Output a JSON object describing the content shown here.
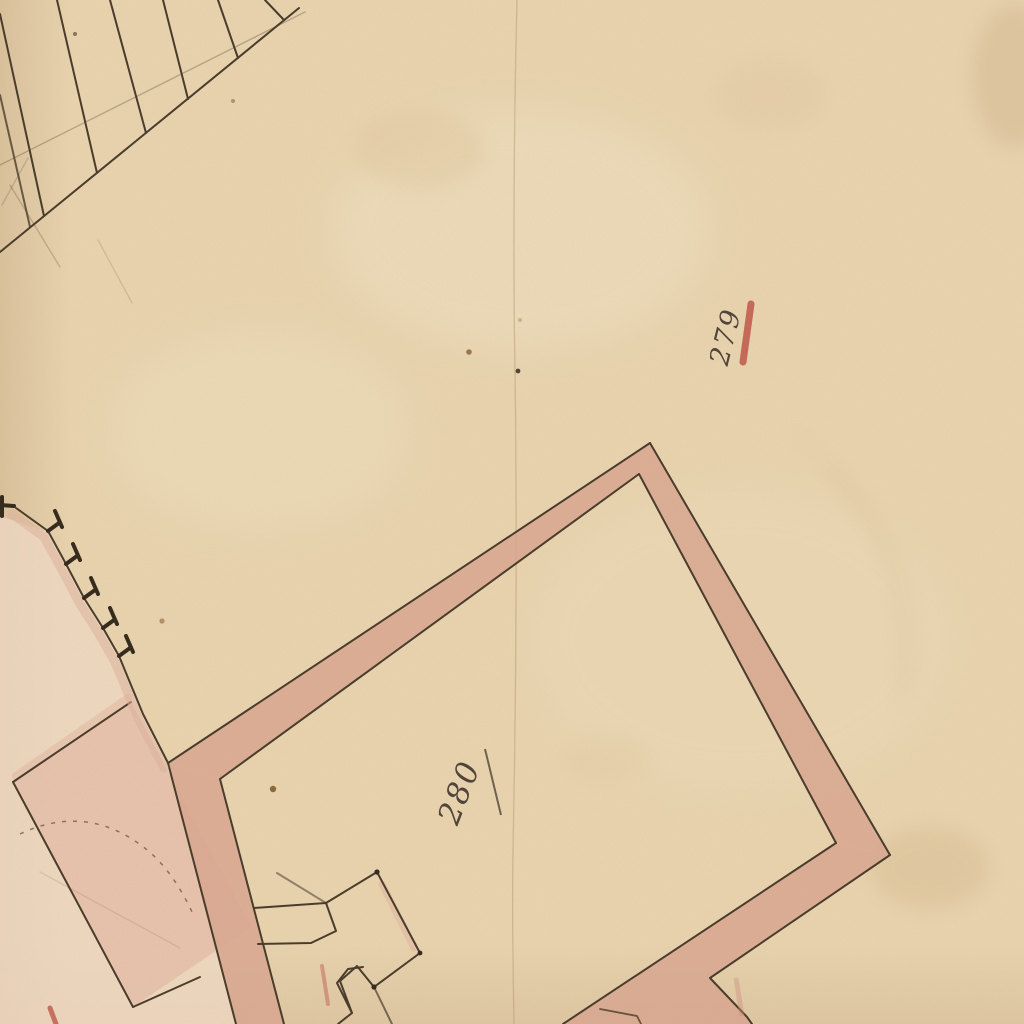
{
  "document": {
    "kind": "scanned historic hand-drawn cadastral plan",
    "sheet": "aged laid paper with sepia ink linework and rose wash poche"
  },
  "labels": {
    "parcel_279": "279",
    "parcel_280": "280"
  },
  "marks": {
    "red_tick": "red ink tick beside parcel number 279",
    "underline": "ink underline stroke beside parcel number 280"
  },
  "features": [
    "hatched strip in top-left corner",
    "buttressed wall with pink wash on left side",
    "large pink-washed building block in bottom-left with dashed arc",
    "large rotated building outline with pink wall fill (parcel 280)",
    "stepped porch structure on south-west wall",
    "vertical paper crease through centre",
    "fox spots and water stains"
  ],
  "colors": {
    "paper": "#e8d3ae",
    "paper_light": "#f2e4c7",
    "paper_dark": "#d9bf99",
    "ink": "#473929",
    "ink_dark": "#32281a",
    "script": "#4e4136",
    "poche": "#d8a58f",
    "poche_deep": "#e6c0aa",
    "wash": "#efd8c3",
    "band": "#dfb29c",
    "red": "#bf5348",
    "red_soft": "#d08a7a",
    "crease": "#ae8865",
    "stain": "#8a5c28"
  }
}
